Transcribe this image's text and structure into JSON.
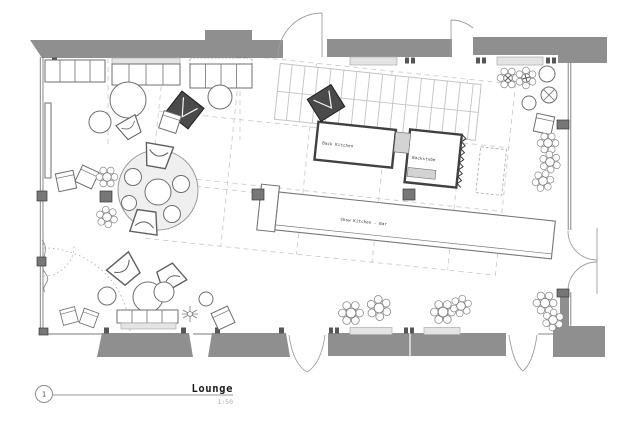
{
  "drawing": {
    "sheet_number": "1",
    "title": "Lounge",
    "scale": "1:50"
  },
  "labels": {
    "back_kitchen": "Back Kitchen",
    "bakery": "Backstube",
    "show_kitchen_bar": "Show Kitchen - Bar"
  },
  "colors": {
    "paper": "#ffffff",
    "wall_fill": "#8f8f8f",
    "kitchen_wall": "#414141",
    "light_fill": "#e4e4e4",
    "grid_dash": "#cdcdcd",
    "stair_line": "#c3c3c3",
    "furniture_line": "#6f6f6f",
    "title_text": "#1a1a1a",
    "muted_text": "#ababab"
  }
}
